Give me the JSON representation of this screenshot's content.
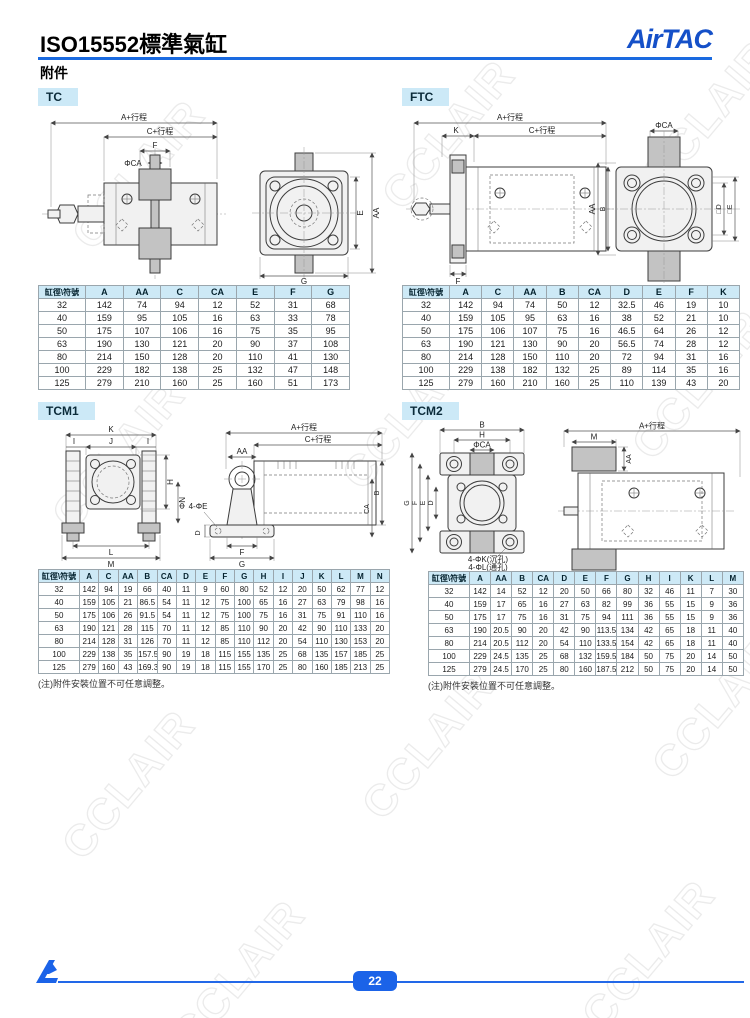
{
  "page": {
    "title": "ISO15552標準氣缸",
    "subtitle": "附件",
    "brand": "AirTAC",
    "page_number": "22",
    "watermark": "CCLAIR",
    "colors": {
      "accent_blue": "#1a6ae0",
      "label_bg": "#cce9f7",
      "table_header_bg": "#cde9f6",
      "logo_blue": "#1550c8"
    }
  },
  "sections": {
    "tc": {
      "label": "TC",
      "drawing": {
        "a": "A+行程",
        "c": "C+行程",
        "f": "F",
        "ca": "ΦCA",
        "e": "E",
        "aa": "AA",
        "g": "G"
      },
      "table": {
        "columns": [
          "缸徑\\符號",
          "A",
          "AA",
          "C",
          "CA",
          "E",
          "F",
          "G"
        ],
        "rows": [
          [
            "32",
            "142",
            "74",
            "94",
            "12",
            "52",
            "31",
            "68"
          ],
          [
            "40",
            "159",
            "95",
            "105",
            "16",
            "63",
            "33",
            "78"
          ],
          [
            "50",
            "175",
            "107",
            "106",
            "16",
            "75",
            "35",
            "95"
          ],
          [
            "63",
            "190",
            "130",
            "121",
            "20",
            "90",
            "37",
            "108"
          ],
          [
            "80",
            "214",
            "150",
            "128",
            "20",
            "110",
            "41",
            "130"
          ],
          [
            "100",
            "229",
            "182",
            "138",
            "25",
            "132",
            "47",
            "148"
          ],
          [
            "125",
            "279",
            "210",
            "160",
            "25",
            "160",
            "51",
            "173"
          ]
        ]
      }
    },
    "ftc": {
      "label": "FTC",
      "drawing": {
        "a": "A+行程",
        "k": "K",
        "c": "C+行程",
        "f": "F",
        "ca": "ΦCA",
        "aa": "AA",
        "b": "B",
        "d": "□D",
        "e": "□E"
      },
      "table": {
        "columns": [
          "缸徑\\符號",
          "A",
          "C",
          "AA",
          "B",
          "CA",
          "D",
          "E",
          "F",
          "K"
        ],
        "rows": [
          [
            "32",
            "142",
            "94",
            "74",
            "50",
            "12",
            "32.5",
            "46",
            "19",
            "10"
          ],
          [
            "40",
            "159",
            "105",
            "95",
            "63",
            "16",
            "38",
            "52",
            "21",
            "10"
          ],
          [
            "50",
            "175",
            "106",
            "107",
            "75",
            "16",
            "46.5",
            "64",
            "26",
            "12"
          ],
          [
            "63",
            "190",
            "121",
            "130",
            "90",
            "20",
            "56.5",
            "74",
            "28",
            "12"
          ],
          [
            "80",
            "214",
            "128",
            "150",
            "110",
            "20",
            "72",
            "94",
            "31",
            "16"
          ],
          [
            "100",
            "229",
            "138",
            "182",
            "132",
            "25",
            "89",
            "114",
            "35",
            "16"
          ],
          [
            "125",
            "279",
            "160",
            "210",
            "160",
            "25",
            "110",
            "139",
            "43",
            "20"
          ]
        ]
      }
    },
    "tcm1": {
      "label": "TCM1",
      "note": "(注)附件安裝位置不可任意調整。",
      "drawing": {
        "a": "A+行程",
        "c": "C+行程",
        "aa": "AA",
        "k": "K",
        "j": "J",
        "i": "I",
        "h": "H",
        "n": "ΦN",
        "l": "L",
        "m": "M",
        "e4": "4-ΦE",
        "d": "D",
        "f": "F",
        "g": "G",
        "b": "B",
        "ca": "CA"
      },
      "table": {
        "columns": [
          "缸徑\\符號",
          "A",
          "C",
          "AA",
          "B",
          "CA",
          "D",
          "E",
          "F",
          "G",
          "H",
          "I",
          "J",
          "K",
          "L",
          "M",
          "N"
        ],
        "rows": [
          [
            "32",
            "142",
            "94",
            "19",
            "66",
            "40",
            "11",
            "9",
            "60",
            "80",
            "52",
            "12",
            "20",
            "50",
            "62",
            "77",
            "12"
          ],
          [
            "40",
            "159",
            "105",
            "21",
            "86.5",
            "54",
            "11",
            "12",
            "75",
            "100",
            "65",
            "16",
            "27",
            "63",
            "79",
            "98",
            "16"
          ],
          [
            "50",
            "175",
            "106",
            "26",
            "91.5",
            "54",
            "11",
            "12",
            "75",
            "100",
            "75",
            "16",
            "31",
            "75",
            "91",
            "110",
            "16"
          ],
          [
            "63",
            "190",
            "121",
            "28",
            "115",
            "70",
            "11",
            "12",
            "85",
            "110",
            "90",
            "20",
            "42",
            "90",
            "110",
            "133",
            "20"
          ],
          [
            "80",
            "214",
            "128",
            "31",
            "126",
            "70",
            "11",
            "12",
            "85",
            "110",
            "112",
            "20",
            "54",
            "110",
            "130",
            "153",
            "20"
          ],
          [
            "100",
            "229",
            "138",
            "35",
            "157.5",
            "90",
            "19",
            "18",
            "115",
            "155",
            "135",
            "25",
            "68",
            "135",
            "157",
            "185",
            "25"
          ],
          [
            "125",
            "279",
            "160",
            "43",
            "169.3",
            "90",
            "19",
            "18",
            "115",
            "155",
            "170",
            "25",
            "80",
            "160",
            "185",
            "213",
            "25"
          ]
        ]
      }
    },
    "tcm2": {
      "label": "TCM2",
      "note": "(注)附件安裝位置不可任意調整。",
      "drawing": {
        "a": "A+行程",
        "m": "M",
        "aa": "AA",
        "b": "B",
        "h": "H",
        "ca": "ΦCA",
        "g": "G",
        "f": "F",
        "e": "E",
        "d": "D",
        "k4": "4-ΦK(沉孔)",
        "l4": "4-ΦL(通孔)"
      },
      "table": {
        "columns": [
          "缸徑\\符號",
          "A",
          "AA",
          "B",
          "CA",
          "D",
          "E",
          "F",
          "G",
          "H",
          "I",
          "K",
          "L",
          "M"
        ],
        "rows": [
          [
            "32",
            "142",
            "14",
            "52",
            "12",
            "20",
            "50",
            "66",
            "80",
            "32",
            "46",
            "11",
            "7",
            "30"
          ],
          [
            "40",
            "159",
            "17",
            "65",
            "16",
            "27",
            "63",
            "82",
            "99",
            "36",
            "55",
            "15",
            "9",
            "36"
          ],
          [
            "50",
            "175",
            "17",
            "75",
            "16",
            "31",
            "75",
            "94",
            "111",
            "36",
            "55",
            "15",
            "9",
            "36"
          ],
          [
            "63",
            "190",
            "20.5",
            "90",
            "20",
            "42",
            "90",
            "113.5",
            "134",
            "42",
            "65",
            "18",
            "11",
            "40"
          ],
          [
            "80",
            "214",
            "20.5",
            "112",
            "20",
            "54",
            "110",
            "133.5",
            "154",
            "42",
            "65",
            "18",
            "11",
            "40"
          ],
          [
            "100",
            "229",
            "24.5",
            "135",
            "25",
            "68",
            "132",
            "159.5",
            "184",
            "50",
            "75",
            "20",
            "14",
            "50"
          ],
          [
            "125",
            "279",
            "24.5",
            "170",
            "25",
            "80",
            "160",
            "187.5",
            "212",
            "50",
            "75",
            "20",
            "14",
            "50"
          ]
        ]
      }
    }
  }
}
